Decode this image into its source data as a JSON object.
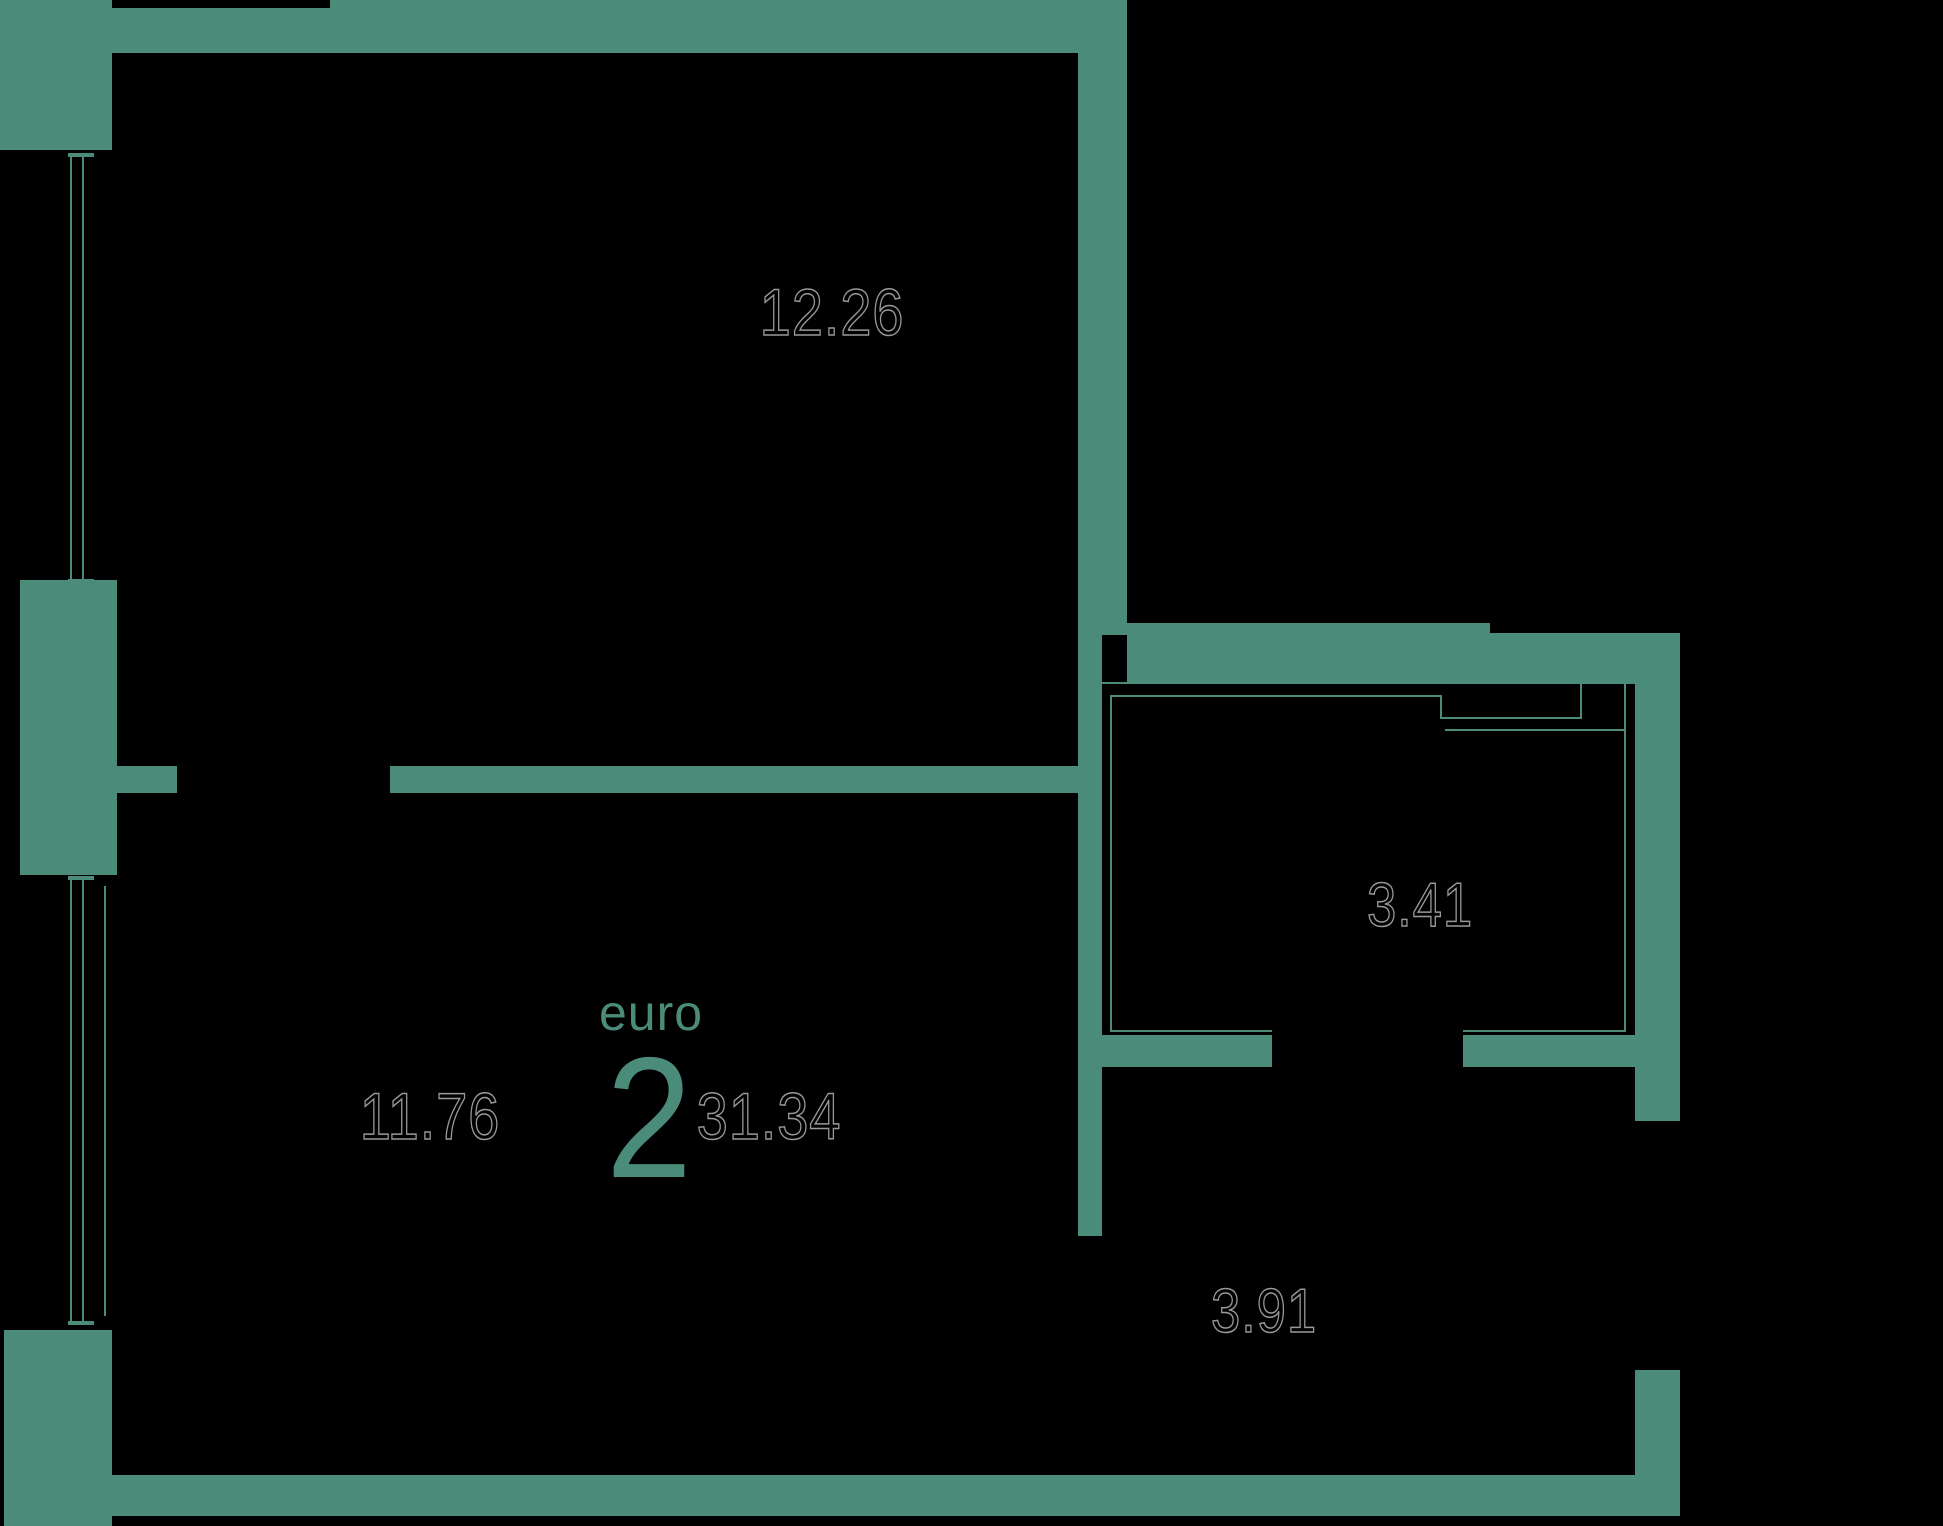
{
  "plan": {
    "unit": {
      "type_label": "euro",
      "rooms_count": "2",
      "total_area": "31.34"
    },
    "rooms": [
      {
        "id": "bedroom",
        "area": "12.26"
      },
      {
        "id": "living-room",
        "area": "11.76"
      },
      {
        "id": "bathroom",
        "area": "3.41"
      },
      {
        "id": "hallway",
        "area": "3.91"
      }
    ]
  },
  "colors": {
    "wall_teal": "#4A8C79",
    "background": "#000000",
    "number_fill": "#000000",
    "number_outline": "#999999"
  }
}
